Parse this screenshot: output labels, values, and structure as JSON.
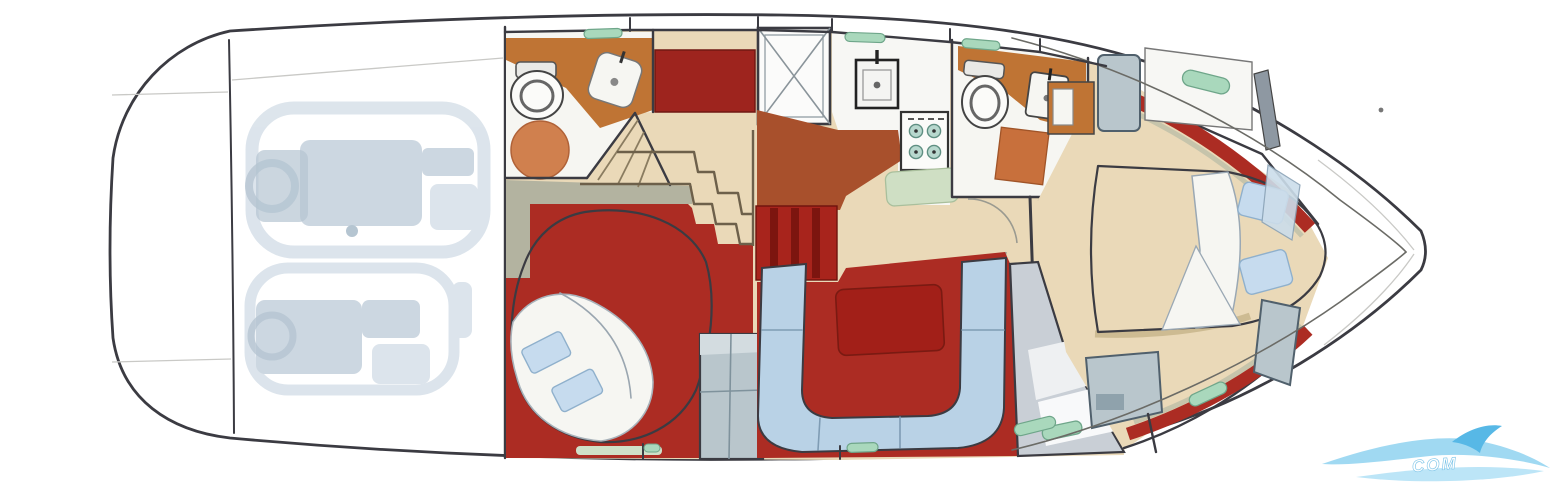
{
  "diagram": {
    "type": "yacht-floor-plan",
    "view": "overhead-deck-plan",
    "orientation": "bow-right-stern-left",
    "watermark_text": "COM",
    "rooms": [
      "swim-platform",
      "engine-room",
      "aft-head",
      "aft-cabin",
      "companionway-stairs",
      "shower",
      "galley",
      "mid-head",
      "salon-dinette",
      "forward-passage",
      "forward-cabin",
      "bow-deck"
    ],
    "furniture": [
      "twin-engines",
      "toilet",
      "vanity-sink",
      "round-rug",
      "shower-pan",
      "galley-sink",
      "stove-4-burner",
      "floor-mat",
      "double-bed-aft",
      "u-shaped-settee",
      "dinette-table",
      "companionway-steps",
      "wardrobe",
      "island-bed-forward",
      "pillows",
      "deck-hatches"
    ]
  },
  "colors": {
    "line_dark": "#3b3b42",
    "line_mid": "#6b6b66",
    "carpet_red": "#ac2c23",
    "table_red": "#a21f18",
    "steps_red": "#a8241c",
    "steps_red_dark": "#7c150f",
    "block_red": "#9e241e",
    "counter_terracotta": "#bf7434",
    "floor_terracotta": "#a8502c",
    "rug_orange": "#d0804e",
    "mat_orange": "#c8703c",
    "floor_beige": "#ead9b8",
    "beige_shadow": "#cdbb92",
    "olive_wall": "#b3b3a0",
    "bed_blue": "#b7d0e5",
    "bed_hatch_line": "#9ab8d2",
    "pillow_blue": "#c6dbee",
    "settee_blue": "#b9d2e6",
    "soft_white": "#f6f6f2",
    "cabinet_gray": "#b9c6cc",
    "cabinet_gray_dark": "#50606c",
    "sage_mat": "#cfdfc4",
    "sage_shelf": "#cfe0c8",
    "hatch_green": "#a9d8bc",
    "hatch_green_stroke": "#6fa68a",
    "engine_ghost": "#d9e2ea",
    "engine_ghost_mid": "#c7d3de",
    "engine_ghost_dark": "#aebfcd",
    "watermark_light": "#8fd2f0",
    "watermark_mid": "#57b8e6",
    "watermark_pale": "#b5e2f6"
  }
}
